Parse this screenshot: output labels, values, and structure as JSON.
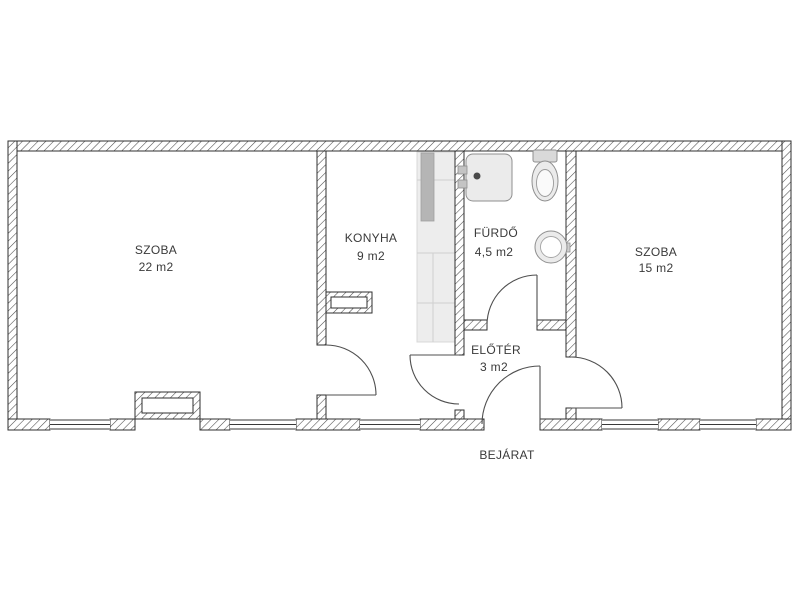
{
  "plan": {
    "rooms": [
      {
        "key": "szoba-left",
        "name": "SZOBA",
        "area": "22 m2"
      },
      {
        "key": "konyha",
        "name": "KONYHA",
        "area": "9 m2"
      },
      {
        "key": "furdo",
        "name": "FÜRDŐ",
        "area": "4,5 m2"
      },
      {
        "key": "szoba-right",
        "name": "SZOBA",
        "area": "15 m2"
      },
      {
        "key": "eloter",
        "name": "ELŐTÉR",
        "area": "3 m2"
      }
    ],
    "entrance_label": "BEJÁRAT",
    "fixtures": [
      "bathtub",
      "toilet",
      "washbasin",
      "kitchen-counter",
      "kitchen-appliance",
      "radiator-szoba",
      "radiator-konyha"
    ],
    "colors": {
      "background": "#ffffff",
      "wall_line": "#2f2f2f",
      "door_line": "#4f4f4f",
      "counter_fill": "#ededed",
      "appliance_fill": "#b5b5b5",
      "fixture_fill": "#ebebeb",
      "fixture_stroke": "#8f8f8f",
      "text": "#3a3a3a"
    }
  }
}
